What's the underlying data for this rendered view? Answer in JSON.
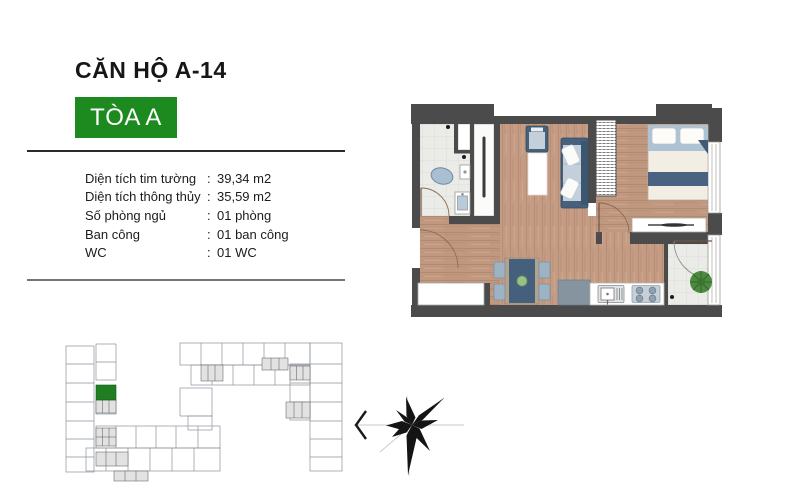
{
  "header": {
    "title": "CĂN HỘ A-14",
    "building_badge": "TÒA A"
  },
  "specs": {
    "separator": ":",
    "rows": [
      {
        "label": "Diện tích tim tường",
        "value": "39,34 m2"
      },
      {
        "label": "Diện tích thông thủy",
        "value": "35,59 m2"
      },
      {
        "label": "Số phòng ngủ",
        "value": "01 phòng"
      },
      {
        "label": "Ban công",
        "value": "01 ban công"
      },
      {
        "label": "WC",
        "value": "01 WC"
      }
    ]
  },
  "colors": {
    "accent_green": "#1d8a20",
    "keyplan_highlight_green": "#1f7d22",
    "wall_dark": "#4b4b4b",
    "wood_floor": "#c49c84",
    "tile_floor": "#ebebe7",
    "furniture_navy": "#47617c",
    "cushion_blue": "#c3d0db",
    "plant_green": "#4c8a3f"
  }
}
